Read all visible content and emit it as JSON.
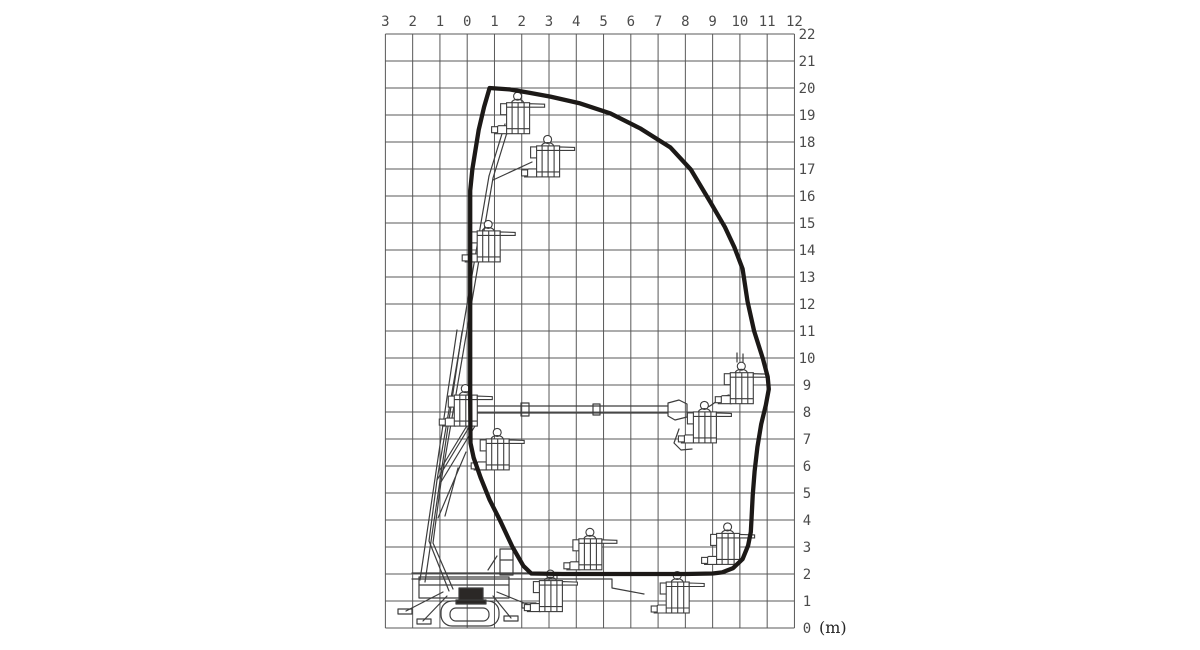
{
  "diagram": {
    "unit_label": "(m)",
    "x_axis": {
      "labels": [
        "3",
        "2",
        "1",
        "0",
        "1",
        "2",
        "3",
        "4",
        "5",
        "6",
        "7",
        "8",
        "9",
        "10",
        "11",
        "12"
      ],
      "min_m": -3,
      "max_m": 12
    },
    "y_axis": {
      "labels": [
        "22",
        "21",
        "20",
        "19",
        "18",
        "17",
        "16",
        "15",
        "14",
        "13",
        "12",
        "11",
        "10",
        "9",
        "8",
        "7",
        "6",
        "5",
        "4",
        "3",
        "2",
        "1",
        "0"
      ],
      "min_m": 0,
      "max_m": 22
    },
    "grid": {
      "x0_px": 467.2,
      "y0_px": 628,
      "px_per_m_x": 27.27,
      "px_per_m_y": 27.0,
      "left_px": 385.4,
      "top_px": 34,
      "right_px": 794.4,
      "bottom_px": 628
    },
    "colors": {
      "background": "#ffffff",
      "grid_line": "#585858",
      "envelope": "#1c1917",
      "line_art": "#3d3d3d",
      "axis_label": "#4b4b4b",
      "fill_dark": "#2b2826"
    },
    "envelope": {
      "stroke_width_px": 4.3,
      "points_m": [
        [
          0.82,
          20.0
        ],
        [
          1.55,
          19.95
        ],
        [
          2.3,
          19.82
        ],
        [
          3.05,
          19.68
        ],
        [
          4.1,
          19.44
        ],
        [
          5.25,
          19.06
        ],
        [
          6.35,
          18.5
        ],
        [
          7.45,
          17.8
        ],
        [
          8.2,
          16.98
        ],
        [
          8.9,
          15.8
        ],
        [
          9.45,
          14.85
        ],
        [
          9.8,
          14.1
        ],
        [
          10.1,
          13.3
        ],
        [
          10.28,
          12.1
        ],
        [
          10.52,
          11.0
        ],
        [
          10.85,
          9.95
        ],
        [
          11.02,
          9.3
        ],
        [
          11.06,
          8.85
        ],
        [
          10.95,
          8.25
        ],
        [
          10.78,
          7.55
        ],
        [
          10.64,
          6.7
        ],
        [
          10.54,
          5.8
        ],
        [
          10.47,
          4.9
        ],
        [
          10.43,
          4.1
        ],
        [
          10.4,
          3.55
        ],
        [
          10.3,
          3.05
        ],
        [
          10.1,
          2.55
        ],
        [
          9.75,
          2.22
        ],
        [
          9.35,
          2.06
        ],
        [
          9.0,
          2.02
        ],
        [
          8.0,
          2.0
        ],
        [
          6.5,
          2.0
        ],
        [
          5.0,
          2.0
        ],
        [
          3.5,
          2.0
        ],
        [
          2.35,
          2.02
        ],
        [
          2.06,
          2.3
        ],
        [
          1.66,
          3.0
        ],
        [
          1.22,
          3.95
        ],
        [
          0.82,
          4.75
        ],
        [
          0.5,
          5.55
        ],
        [
          0.24,
          6.3
        ],
        [
          0.12,
          6.85
        ],
        [
          0.11,
          8.5
        ],
        [
          0.11,
          10.5
        ],
        [
          0.11,
          12.5
        ],
        [
          0.11,
          14.5
        ],
        [
          0.11,
          16.2
        ],
        [
          0.19,
          17.0
        ],
        [
          0.42,
          18.45
        ],
        [
          0.62,
          19.3
        ],
        [
          0.82,
          20.0
        ]
      ]
    },
    "platform_positions_m": [
      {
        "x": 1.85,
        "y": 18.9
      },
      {
        "x": 2.95,
        "y": 17.3
      },
      {
        "x": 0.77,
        "y": 14.15
      },
      {
        "x": -0.07,
        "y": 8.07
      },
      {
        "x": 1.1,
        "y": 6.45
      },
      {
        "x": 8.7,
        "y": 7.45
      },
      {
        "x": 10.05,
        "y": 8.9
      },
      {
        "x": 4.5,
        "y": 2.75
      },
      {
        "x": 9.55,
        "y": 2.95
      },
      {
        "x": 3.05,
        "y": 1.2
      },
      {
        "x": 7.7,
        "y": 1.15
      }
    ],
    "icons": {
      "platform": "work-platform-icon",
      "machine": "spider-lift-illustration"
    }
  }
}
